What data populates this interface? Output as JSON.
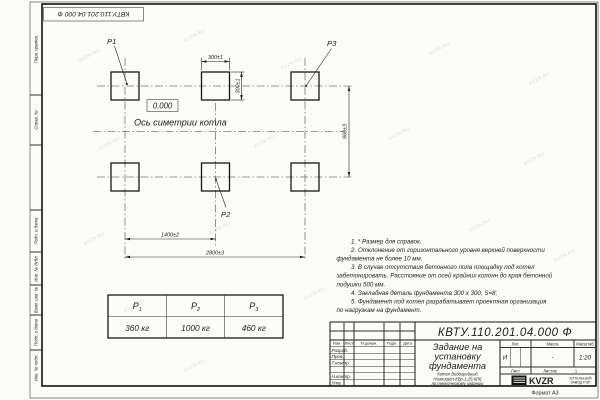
{
  "stamp": {
    "doc_number": "КВТУ.110.201.04.000  Ф"
  },
  "watermark": {
    "text": "KVZR.RU"
  },
  "sidebar": {
    "labels": [
      "Перв. примен.",
      "Справ. №",
      "Подп. и дата",
      "Инв. № дубл.",
      "Взам. инв. №",
      "Подп. и дата",
      "Инв. № подл."
    ]
  },
  "drawing": {
    "pad_labels": {
      "p1": "P1",
      "p2": "P2",
      "p3": "P3"
    },
    "elevation": "0.000",
    "axis_label": "Ось симетрии котла",
    "dimensions": {
      "pad_width": "300±1",
      "pad_height": "300±1",
      "row_spacing": "960±3",
      "col_spacing": "1400±2",
      "total_span": "2800±3"
    }
  },
  "weights_table": {
    "headers": [
      {
        "sym": "P",
        "sub": "1"
      },
      {
        "sym": "P",
        "sub": "2"
      },
      {
        "sym": "P",
        "sub": "3"
      }
    ],
    "values": [
      "360 кг",
      "1000 кг",
      "460 кг"
    ]
  },
  "notes": {
    "lines": [
      "1. * Размер для справок.",
      "2. Отклонение от горизонтального уровня верхней поверхности",
      "фундамента не более 10 мм.",
      "3. В случае отсутствия бетонного пола площадку под котел",
      "забетонировать. Расстояние от осей крайних колонн до края бетонной",
      "подушки 500 мм.",
      "4. Закладная деталь фундамента  300 х 300, S=8;",
      "5. Фундамент под котел разрабатывает проектная организация",
      "по нагрузкам на фундамент."
    ]
  },
  "title_block": {
    "doc_number": "КВТУ.110.201.04.000  Ф",
    "title_line1": "Задание на",
    "title_line2": "установку",
    "title_line3": "фундамента",
    "subtitle_line1": "Котел Водогрейный",
    "subtitle_line2": "Heatexpert-КВр-1,25-К(К)",
    "subtitle_line3": "по техническому заданию",
    "col_izm": "Изм.",
    "col_list": "Лист",
    "col_doc": "N докум.",
    "col_podp": "Подп.",
    "col_data": "Дата",
    "row_razrab": "Разраб.",
    "row_prov": "Пров.",
    "row_tkontr": "Т.контр.",
    "row_nkontr": "Н.контр.",
    "row_utv": "Утв.",
    "lit_label": "Лит.",
    "lit_value": "И",
    "mass_label": "Масса",
    "mass_value": "-",
    "scale_label": "Масштаб",
    "scale_value": "1:20",
    "sheet_label": "Лист",
    "sheets_label": "Листов",
    "sheets_value": "1",
    "logo_text": "KVZR",
    "org_line1": "КОТЕЛЬНЫЙ",
    "org_line2": "ЗАВОД РЭП",
    "format_label": "Формат А3"
  }
}
